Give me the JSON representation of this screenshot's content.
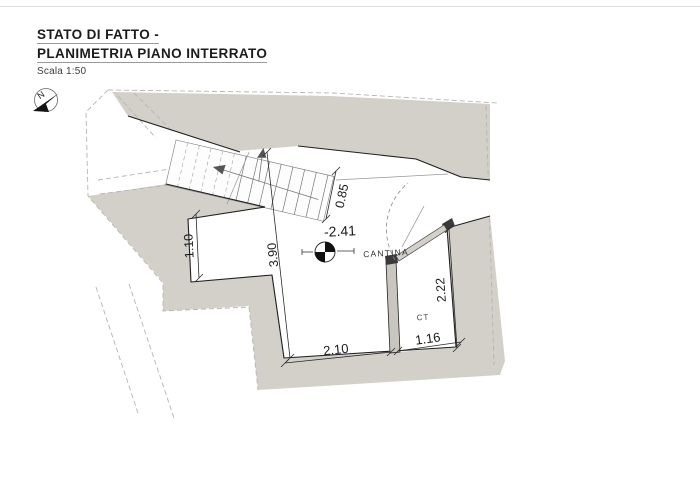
{
  "header": {
    "title_line1": "STATO DI FATTO -",
    "title_line2": "PLANIMETRIA PIANO INTERRATO",
    "scale": "Scala 1:50"
  },
  "compass": {
    "label": "N"
  },
  "plan": {
    "level_annotation": "-2.41",
    "rooms": [
      {
        "name": "CANTINA"
      },
      {
        "name": "CT"
      }
    ],
    "dimensions": [
      {
        "id": "stair-width",
        "value": "0.85"
      },
      {
        "id": "alcove-depth",
        "value": "1.10"
      },
      {
        "id": "room-length",
        "value": "3.90"
      },
      {
        "id": "ct-length",
        "value": "2.22"
      },
      {
        "id": "room-width",
        "value": "2.10"
      },
      {
        "id": "ct-width",
        "value": "1.16"
      }
    ],
    "colors": {
      "wall_fill": "#d3d0ca",
      "cut_line": "#1f1f1f",
      "hidden_line": "#b8b5b0"
    }
  }
}
